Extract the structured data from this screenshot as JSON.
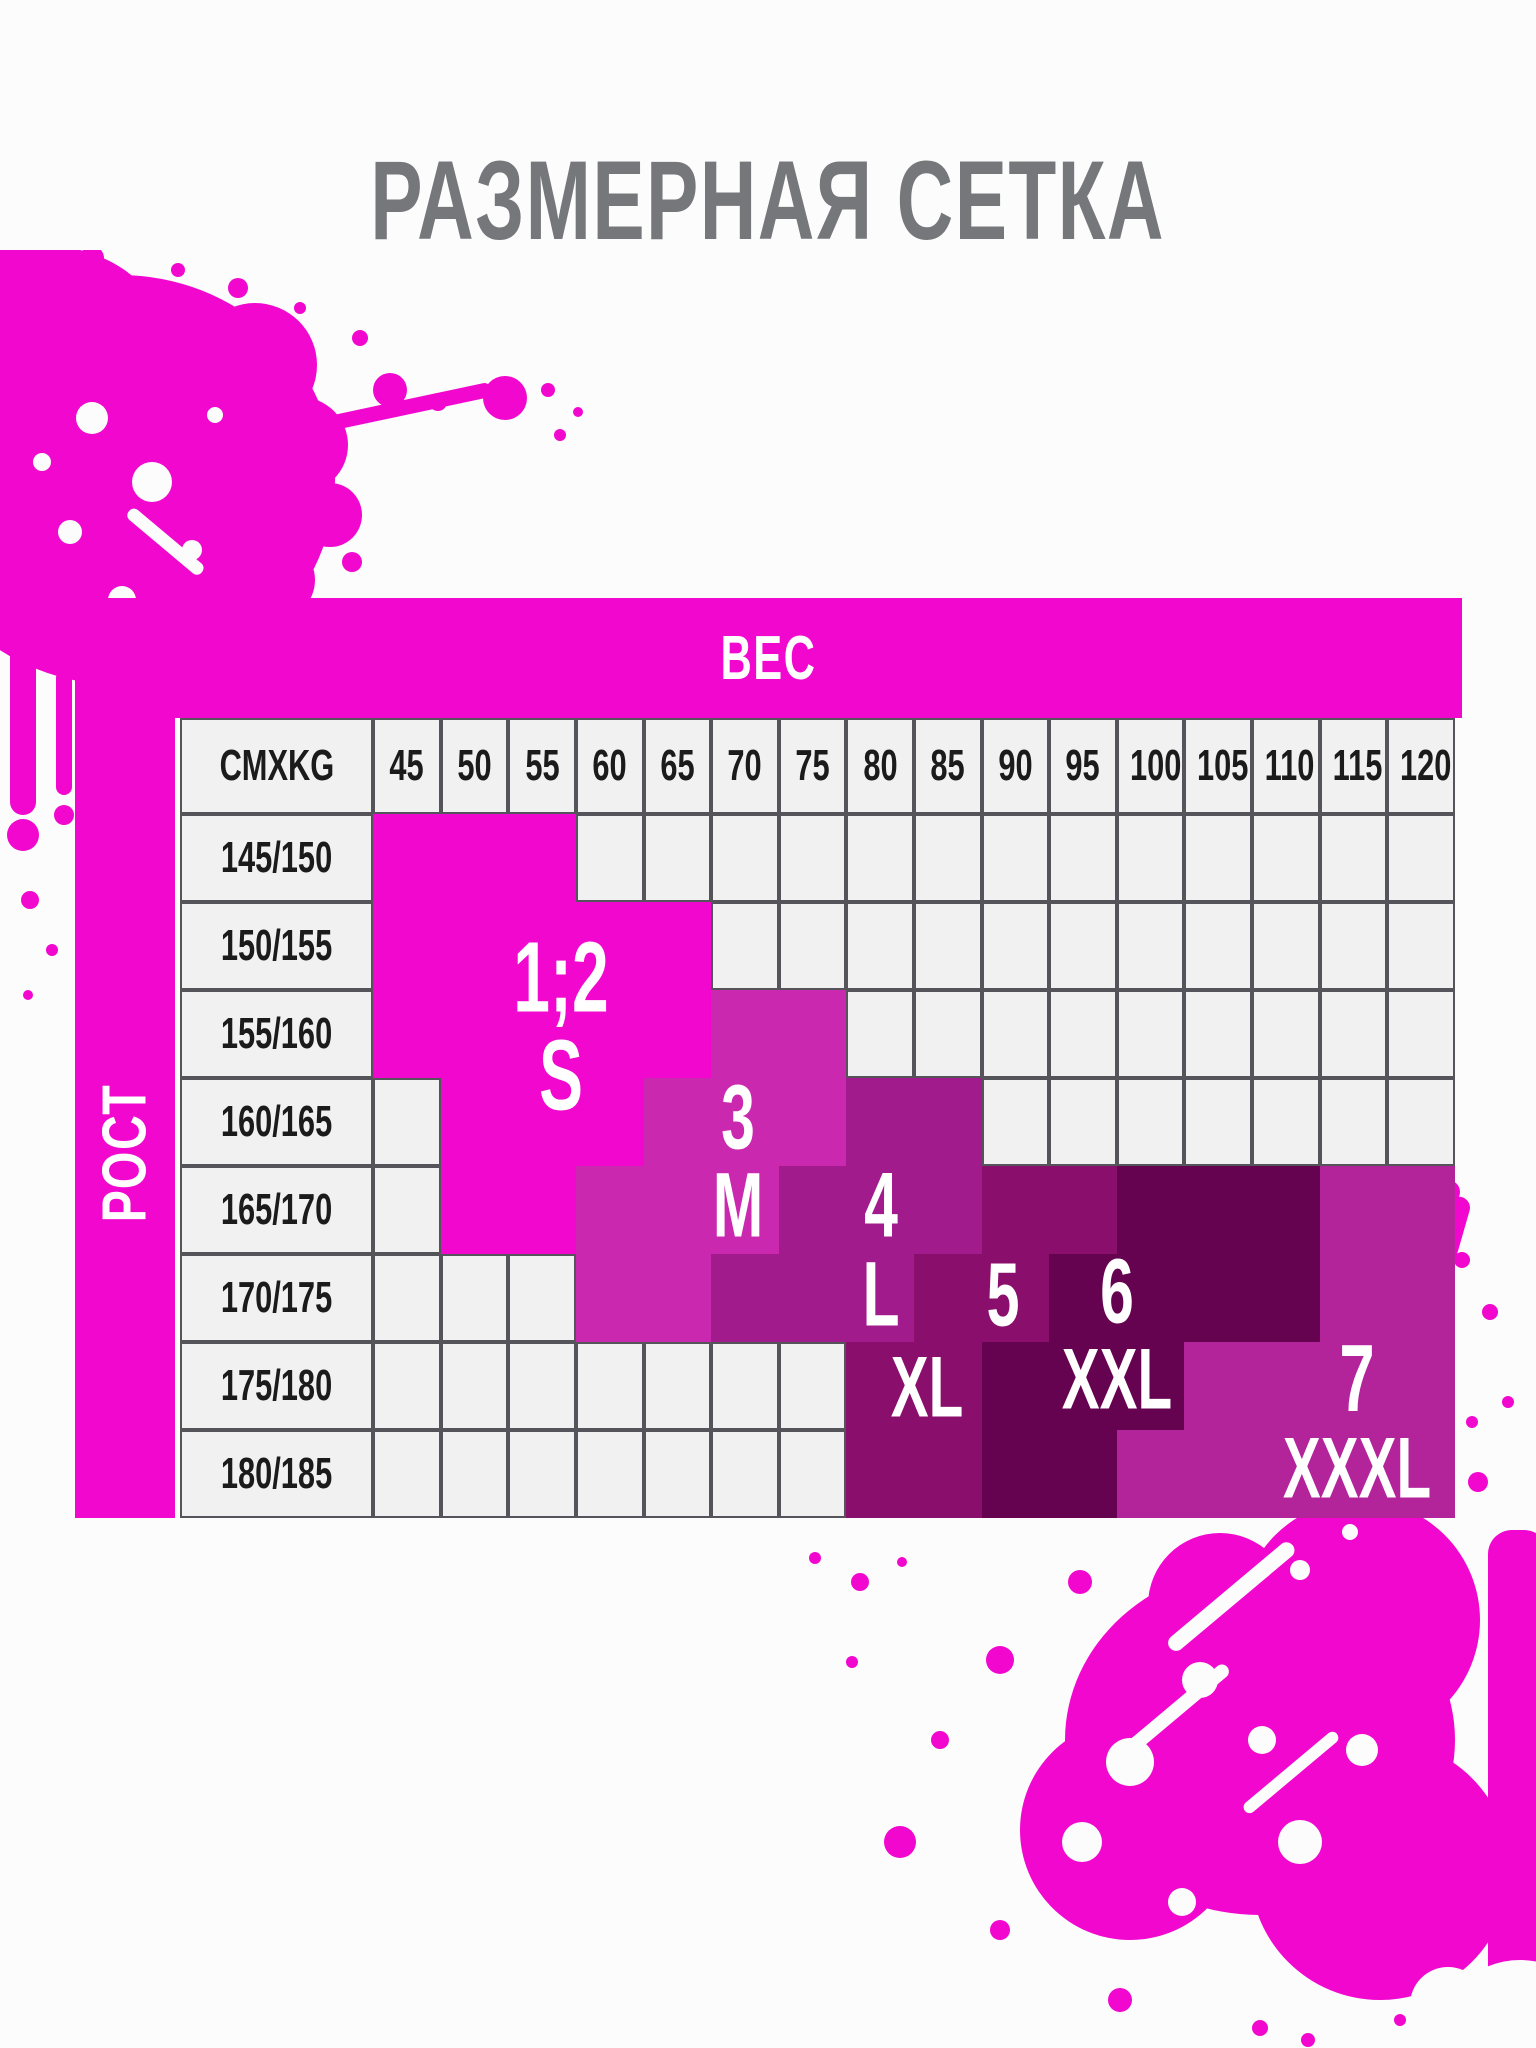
{
  "title": "РАЗМЕРНАЯ СЕТКА",
  "table": {
    "weight_axis_label": "ВЕС",
    "height_axis_label": "РОСТ",
    "corner_label": "CMXKG"
  },
  "chart_data": {
    "type": "heatmap",
    "title": "РАЗМЕРНАЯ СЕТКА",
    "xlabel": "ВЕС",
    "ylabel": "РОСТ",
    "x_categories": [
      "45",
      "50",
      "55",
      "60",
      "65",
      "70",
      "75",
      "80",
      "85",
      "90",
      "95",
      "100",
      "105",
      "110",
      "115",
      "120"
    ],
    "y_categories": [
      "145/150",
      "150/155",
      "155/160",
      "160/165",
      "165/170",
      "170/175",
      "175/180",
      "180/185"
    ],
    "cells": [
      [
        "s",
        "s",
        "s",
        "",
        "",
        "",
        "",
        "",
        "",
        "",
        "",
        "",
        "",
        "",
        "",
        ""
      ],
      [
        "s",
        "s",
        "s",
        "s",
        "s",
        "",
        "",
        "",
        "",
        "",
        "",
        "",
        "",
        "",
        "",
        ""
      ],
      [
        "s",
        "s",
        "s",
        "s",
        "s",
        "m",
        "m",
        "",
        "",
        "",
        "",
        "",
        "",
        "",
        "",
        ""
      ],
      [
        "",
        "s",
        "s",
        "s",
        "m",
        "m",
        "m",
        "l",
        "l",
        "",
        "",
        "",
        "",
        "",
        "",
        ""
      ],
      [
        "",
        "s",
        "s",
        "m",
        "m",
        "m",
        "l",
        "l",
        "l",
        "xl",
        "xl",
        "xxl",
        "xxl",
        "xxl",
        "xxxl",
        "xxxl"
      ],
      [
        "",
        "",
        "",
        "m",
        "m",
        "l",
        "l",
        "l",
        "xl",
        "xl",
        "xxl",
        "xxl",
        "xxl",
        "xxl",
        "xxxl",
        "xxxl"
      ],
      [
        "",
        "",
        "",
        "",
        "",
        "",
        "",
        "xl",
        "xl",
        "xxl",
        "xxl",
        "xxl",
        "xxxl",
        "xxxl",
        "xxxl",
        "xxxl"
      ],
      [
        "",
        "",
        "",
        "",
        "",
        "",
        "",
        "xl",
        "xl",
        "xxl",
        "xxl",
        "xxxl",
        "xxxl",
        "xxxl",
        "xxxl",
        "xxxl"
      ]
    ],
    "legend": [
      {
        "code": "s",
        "number_label": "1;2",
        "size_label": "S"
      },
      {
        "code": "m",
        "number_label": "3",
        "size_label": "M"
      },
      {
        "code": "l",
        "number_label": "4",
        "size_label": "L"
      },
      {
        "code": "xl",
        "number_label": "5",
        "size_label": "XL"
      },
      {
        "code": "xxl",
        "number_label": "6",
        "size_label": "XXL"
      },
      {
        "code": "xxxl",
        "number_label": "7",
        "size_label": "XXXL"
      }
    ]
  },
  "zone_labels": [
    {
      "text": "1;2",
      "x": 486,
      "y": 380,
      "size": 100
    },
    {
      "text": "S",
      "x": 486,
      "y": 478,
      "size": 100
    },
    {
      "text": "3",
      "x": 663,
      "y": 520,
      "size": 92
    },
    {
      "text": "M",
      "x": 663,
      "y": 608,
      "size": 92
    },
    {
      "text": "4",
      "x": 806,
      "y": 608,
      "size": 92
    },
    {
      "text": "L",
      "x": 806,
      "y": 697,
      "size": 92
    },
    {
      "text": "5",
      "x": 928,
      "y": 698,
      "size": 90
    },
    {
      "text": "XL",
      "x": 852,
      "y": 790,
      "size": 86
    },
    {
      "text": "6",
      "x": 1042,
      "y": 694,
      "size": 92
    },
    {
      "text": "XXL",
      "x": 1042,
      "y": 782,
      "size": 86
    },
    {
      "text": "7",
      "x": 1282,
      "y": 781,
      "size": 96
    },
    {
      "text": "XXXL",
      "x": 1282,
      "y": 871,
      "size": 86
    }
  ],
  "colors": {
    "magenta": "#f207cf",
    "s": "#f207cf",
    "m": "#cb28b0",
    "l": "#a21b8c",
    "xl": "#8a0e6b",
    "xxl": "#650351",
    "xxxl": "#b3239a",
    "grid_cell": "#f2f1f2",
    "grid_border": "#55545a",
    "title_gray": "#76777b",
    "cell_text": "#1b1b1b",
    "label_white": "#ffffff"
  }
}
